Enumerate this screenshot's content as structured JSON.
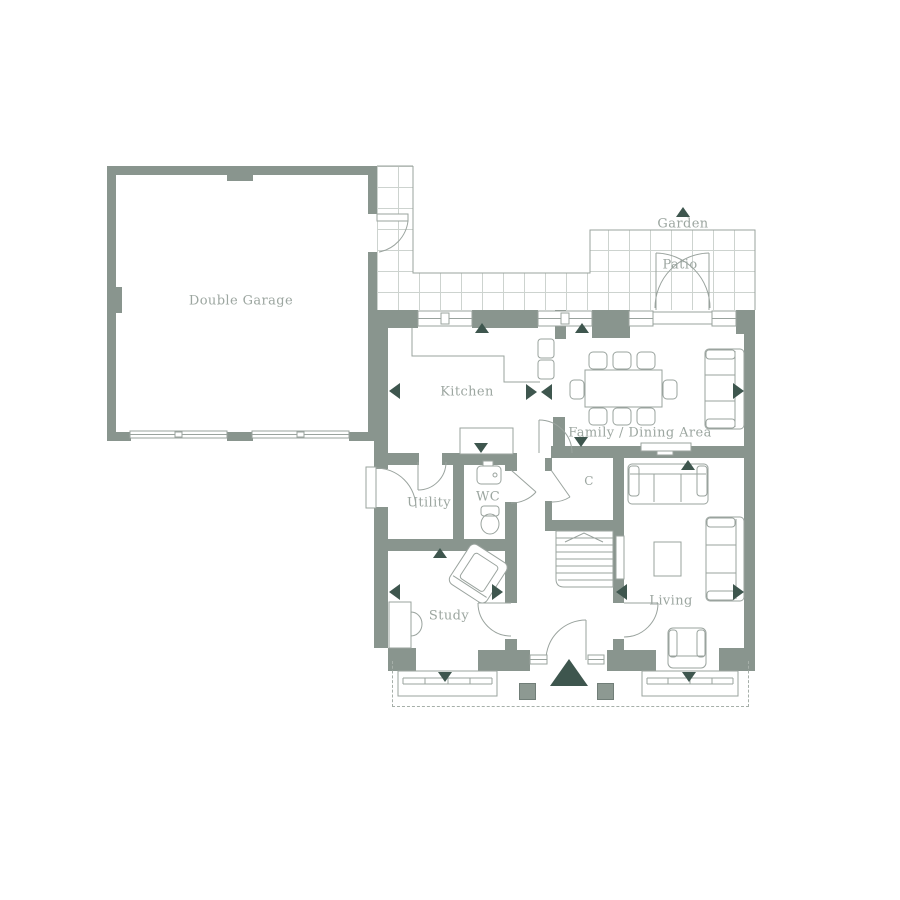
{
  "title": "Ground floor plan",
  "rooms": {
    "double_garage": "Double Garage",
    "kitchen": "Kitchen",
    "family_dining": "Family / Dining Area",
    "utility": "Utility",
    "wc": "WC",
    "cupboard": "C",
    "study": "Study",
    "living": "Living"
  },
  "outdoor": {
    "garden": "Garden",
    "patio": "Patio"
  },
  "colors": {
    "wall": "#89958E",
    "accent": "#3E564E",
    "line": "#9AA39E",
    "tile": "#CDD3CF",
    "label": "#9CA6A0",
    "porch": "#8D9992",
    "porchb": "#717E78",
    "dash": "#A6AFA9",
    "bg": "#FFFFFF"
  }
}
